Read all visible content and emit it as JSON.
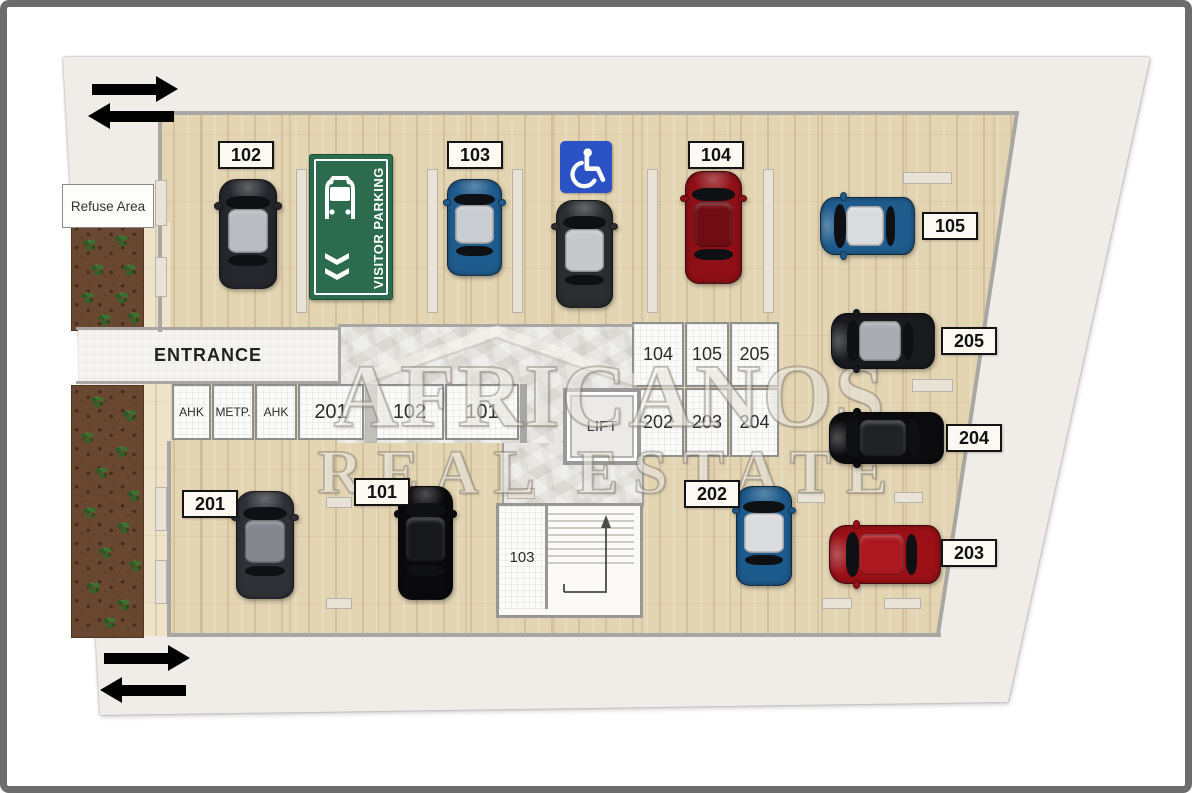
{
  "plan": {
    "refuse_area": "Refuse Area",
    "entrance": "ENTRANCE",
    "lift": "LIFT",
    "stair_room": "103",
    "visitor_sign": {
      "label": "VISITOR PARKING",
      "color": "#2c6b4e",
      "icon": "car-front-icon"
    },
    "accessible": {
      "icon": "wheelchair-icon",
      "color": "#2a52c4"
    },
    "watermark": {
      "line1": "AFRICANOS",
      "line2": "REAL ESTATE"
    },
    "storage_row": [
      "AHK",
      "METP.",
      "AHK",
      "201",
      "102",
      "101"
    ],
    "storage_grid": [
      [
        "104",
        "105",
        "205"
      ],
      [
        "202",
        "203",
        "204"
      ]
    ],
    "direction_arrows": [
      {
        "dir": "right",
        "x": 92,
        "y": 76
      },
      {
        "dir": "left",
        "x": 88,
        "y": 103
      },
      {
        "dir": "right",
        "x": 104,
        "y": 645
      },
      {
        "dir": "left",
        "x": 100,
        "y": 677
      }
    ],
    "spots": [
      {
        "number": "102",
        "label": {
          "x": 218,
          "y": 141
        },
        "car": {
          "x": 219,
          "y": 179,
          "w": 58,
          "h": 110,
          "orient": "v",
          "body": "#26272c",
          "roof": "#b9bcc0"
        }
      },
      {
        "number": "103",
        "label": {
          "x": 447,
          "y": 141
        },
        "car": {
          "x": 447,
          "y": 179,
          "w": 55,
          "h": 97,
          "orient": "v",
          "body": "#1f5c8e",
          "roof": "#c9ccd1"
        }
      },
      {
        "number": "104",
        "label": {
          "x": 688,
          "y": 141
        },
        "car": {
          "x": 685,
          "y": 171,
          "w": 57,
          "h": 113,
          "orient": "v",
          "body": "#8e1016",
          "roof": "#700d12"
        }
      },
      {
        "number": "105",
        "label": {
          "x": 922,
          "y": 212
        },
        "car": {
          "x": 820,
          "y": 197,
          "w": 95,
          "h": 58,
          "orient": "h",
          "body": "#1f5c8e",
          "roof": "#d9dbde"
        }
      },
      {
        "number": "205",
        "label": {
          "x": 941,
          "y": 327
        },
        "car": {
          "x": 831,
          "y": 313,
          "w": 104,
          "h": 56,
          "orient": "h",
          "body": "#1a1b1f",
          "roof": "#a9adb2"
        }
      },
      {
        "number": "204",
        "label": {
          "x": 946,
          "y": 424
        },
        "car": {
          "x": 829,
          "y": 412,
          "w": 115,
          "h": 52,
          "orient": "h",
          "body": "#0c0c0e",
          "roof": "#212226"
        }
      },
      {
        "number": "203",
        "label": {
          "x": 941,
          "y": 539
        },
        "car": {
          "x": 829,
          "y": 525,
          "w": 112,
          "h": 59,
          "orient": "h",
          "body": "#9a1016",
          "roof": "#ab1820"
        }
      },
      {
        "number": "202",
        "label": {
          "x": 684,
          "y": 480
        },
        "car": {
          "x": 736,
          "y": 486,
          "w": 56,
          "h": 100,
          "orient": "v",
          "body": "#1d5a8c",
          "roof": "#dadce0"
        }
      },
      {
        "number": "201",
        "label": {
          "x": 182,
          "y": 490
        },
        "car": {
          "x": 236,
          "y": 491,
          "w": 58,
          "h": 108,
          "orient": "v",
          "body": "#2f3137",
          "roof": "#83868c"
        }
      },
      {
        "number": "101",
        "label": {
          "x": 354,
          "y": 478
        },
        "car": {
          "x": 398,
          "y": 486,
          "w": 55,
          "h": 114,
          "orient": "v",
          "body": "#0a0a0c",
          "roof": "#17181b"
        }
      }
    ],
    "accessible_spot_car": {
      "x": 556,
      "y": 200,
      "w": 57,
      "h": 108,
      "orient": "v",
      "body": "#2b2d31",
      "roof": "#c6c8cc"
    }
  }
}
